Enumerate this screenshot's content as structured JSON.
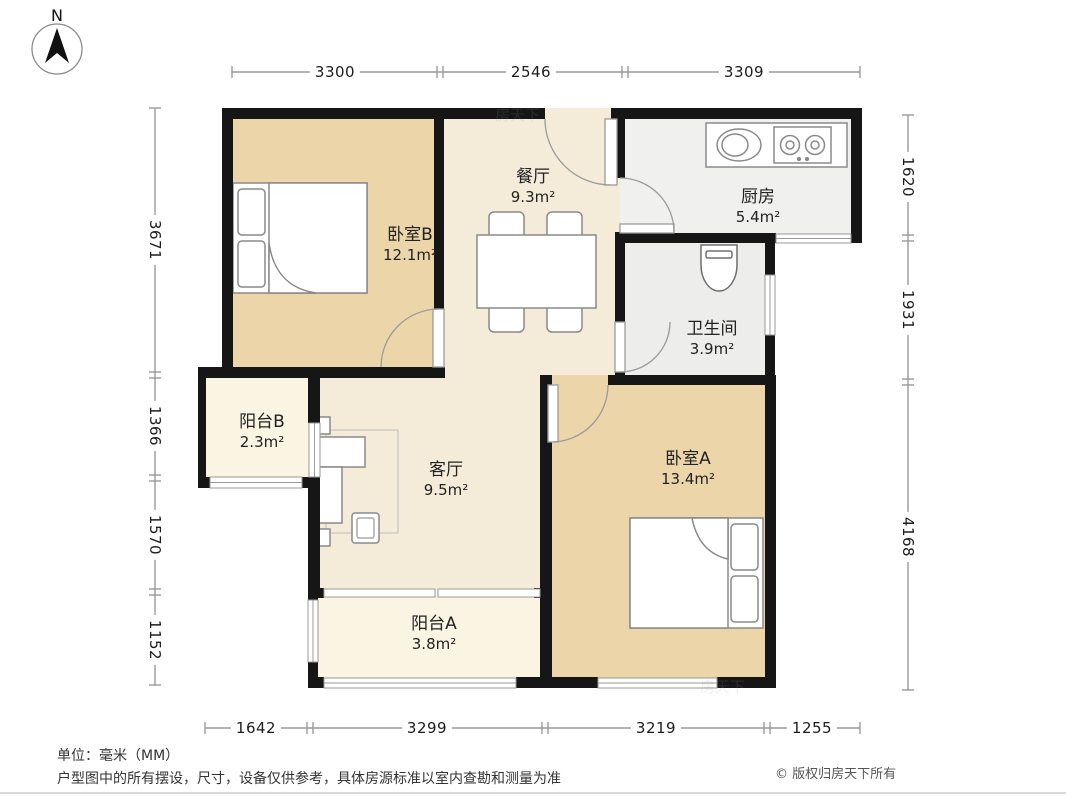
{
  "compass": {
    "label": "N"
  },
  "dimensions": {
    "top": [
      "3300",
      "2546",
      "3309"
    ],
    "bottom": [
      "1642",
      "3299",
      "3219",
      "1255"
    ],
    "left": [
      "3671",
      "1366",
      "1570",
      "1152"
    ],
    "right": [
      "1620",
      "1931",
      "4168"
    ]
  },
  "rooms": {
    "bedroom_b": {
      "name": "卧室B",
      "area": "12.1m²"
    },
    "dining": {
      "name": "餐厅",
      "area": "9.3m²"
    },
    "kitchen": {
      "name": "厨房",
      "area": "5.4m²"
    },
    "bathroom": {
      "name": "卫生间",
      "area": "3.9m²"
    },
    "balcony_b": {
      "name": "阳台B",
      "area": "2.3m²"
    },
    "living": {
      "name": "客厅",
      "area": "9.5m²"
    },
    "bedroom_a": {
      "name": "卧室A",
      "area": "13.4m²"
    },
    "balcony_a": {
      "name": "阳台A",
      "area": "3.8m²"
    }
  },
  "footer": {
    "unit_note": "单位：毫米（MM）",
    "disclaimer": "户型图中的所有摆设，尺寸，设备仅供参考，具体房源标准以室内查勘和测量为准",
    "copyright": "© 版权归房天下所有"
  },
  "watermark": {
    "text": "房天下"
  },
  "colors": {
    "wall": "#161616",
    "bedroom_floor": "#ebd5a9",
    "hall_floor": "#f4ebd9",
    "balcony_floor": "#faf4e3",
    "service_floor": "#efefee",
    "furniture_stroke": "#8a8a8a",
    "dimension_line": "#9a9a9a"
  }
}
